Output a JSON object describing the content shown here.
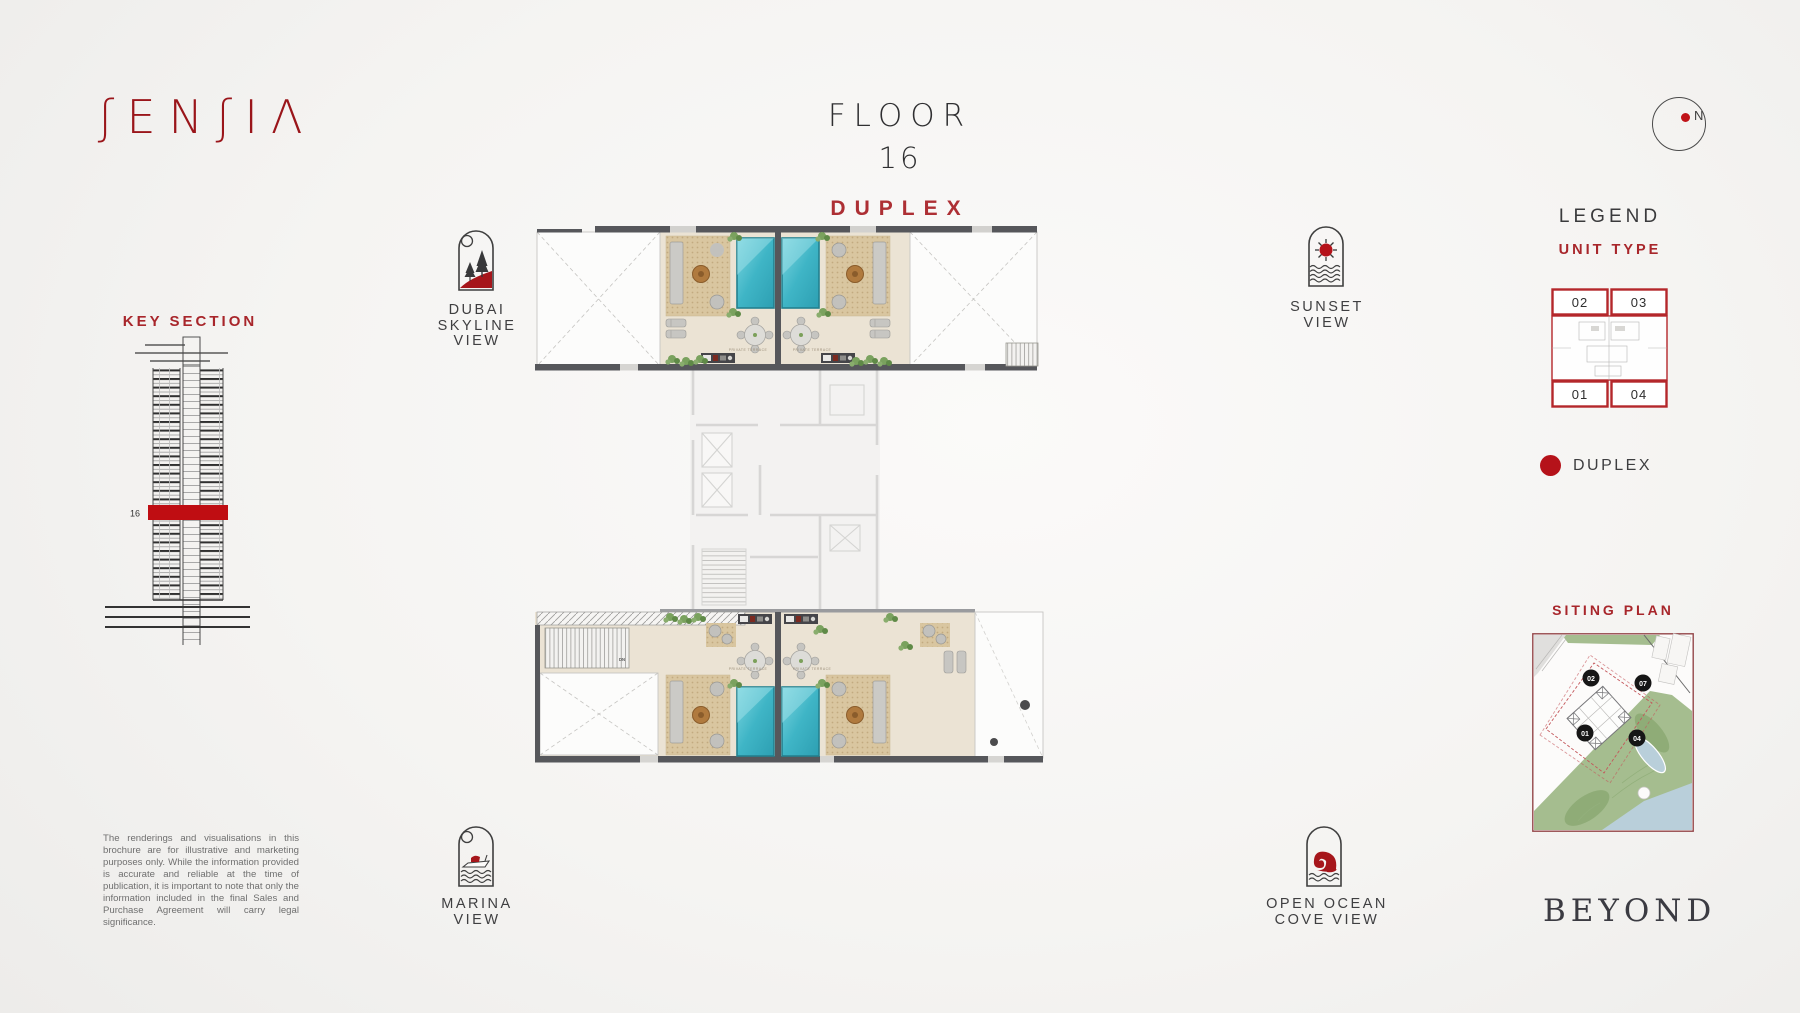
{
  "brand": {
    "name": "SENSIA",
    "stylized": "ʃENʃIΛ",
    "partner": "BEYOND"
  },
  "header": {
    "floor_label": "FLOOR",
    "floor_number": "16",
    "plan_type": "DUPLEX"
  },
  "compass": {
    "north": "N"
  },
  "key_section": {
    "title": "KEY SECTION",
    "highlight_floor": "16"
  },
  "view_labels": {
    "dubai_skyline": {
      "lines": [
        "DUBAI",
        "SKYLINE",
        "VIEW"
      ]
    },
    "marina": {
      "lines": [
        "MARINA",
        "VIEW"
      ]
    },
    "sunset": {
      "lines": [
        "SUNSET",
        "VIEW"
      ]
    },
    "open_ocean": {
      "lines": [
        "OPEN OCEAN",
        "COVE VIEW"
      ]
    }
  },
  "legend": {
    "title": "LEGEND",
    "subtitle": "UNIT TYPE",
    "units": [
      "02",
      "03",
      "01",
      "04"
    ],
    "marker_label": "DUPLEX"
  },
  "siting_plan": {
    "title": "SITING PLAN",
    "markers": [
      "02",
      "07",
      "01",
      "04"
    ]
  },
  "floor_plan": {
    "terrace_label": "PRIVATE TERRACE",
    "down_label": "DN"
  },
  "disclaimer": "The renderings and visualisations in this brochure are for illustrative and marketing purposes only. While the information provided is accurate and reliable at the time of publication, it is important to note that only the information included in the final Sales and Purchase Agreement will carry legal significance.",
  "colors": {
    "accent_red": "#9a151a",
    "legend_red": "#b5121a",
    "pool_teal": "#3fb5c6"
  }
}
